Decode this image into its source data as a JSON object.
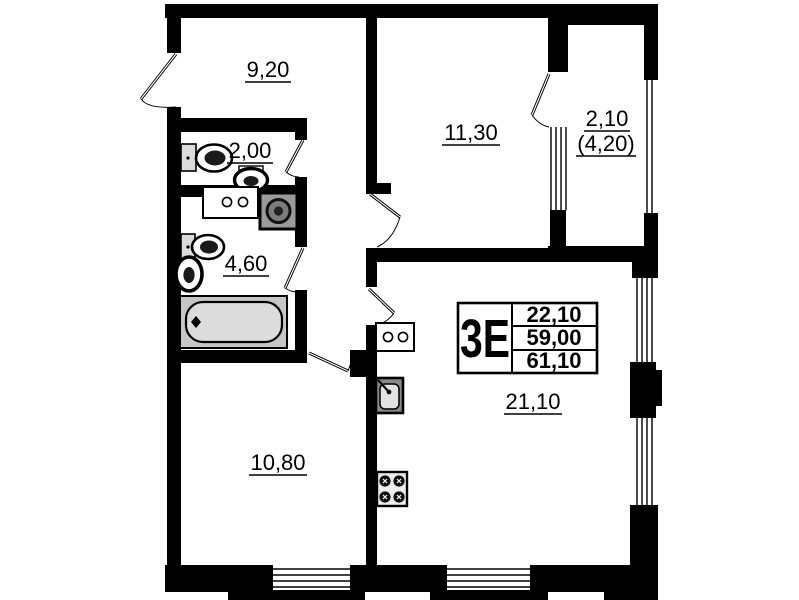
{
  "unit": {
    "type_label": "3Е",
    "stats": {
      "living_area": "22,10",
      "area": "59,00",
      "total_area": "61,10"
    }
  },
  "rooms": {
    "entry_hall": {
      "area": "9,20"
    },
    "wc": {
      "area": "2,00"
    },
    "bathroom": {
      "area": "4,60"
    },
    "bedroom": {
      "area": "11,30"
    },
    "balcony": {
      "area": "2,10",
      "area_coeff": "(4,20)"
    },
    "bedroom2": {
      "area": "10,80"
    },
    "kitchen_living": {
      "area": "21,10"
    }
  },
  "colors": {
    "wall": "#000000",
    "background": "#ffffff",
    "bathtub_fill": "#c6c6c6",
    "tub_inner_fill": "#dcdcdc",
    "appliance_gray": "#9a9a9a",
    "sink_inner": "#e2e2e2"
  }
}
